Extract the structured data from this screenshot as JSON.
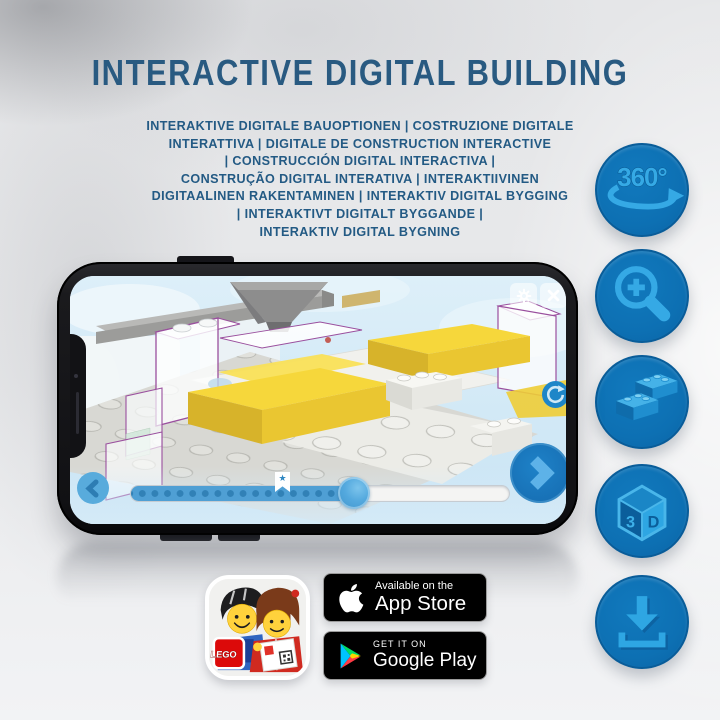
{
  "header": {
    "title": "INTERACTIVE DIGITAL BUILDING",
    "subtitle_lines": [
      "INTERAKTIVE DIGITALE BAUOPTIONEN | COSTRUZIONE DIGITALE",
      "INTERATTIVA | DIGITALE DE CONSTRUCTION INTERACTIVE",
      "| CONSTRUCCIÓN DIGITAL INTERACTIVA |",
      "CONSTRUÇÃO DIGITAL INTERATIVA | INTERAKTIIVINEN",
      "DIGITAALINEN RAKENTAMINEN | INTERAKTIV DIGITAL BYGGING",
      "| INTERAKTIVT DIGITALT BYGGANDE |",
      "INTERAKTIV DIGITAL BYGNING"
    ]
  },
  "features": [
    {
      "icon": "rotation-360-icon",
      "label": "360°"
    },
    {
      "icon": "zoom-in-icon"
    },
    {
      "icon": "lego-bricks-icon"
    },
    {
      "icon": "cube-3d-icon",
      "face_left": "3",
      "face_right": "D"
    },
    {
      "icon": "download-icon"
    }
  ],
  "phone": {
    "slider": {
      "progress_percent": 60,
      "bookmark_star": "★"
    }
  },
  "badges": {
    "lego_app": {
      "logo_text": "LEGO"
    },
    "app_store": {
      "tagline": "Available on the",
      "store_name": "App Store"
    },
    "google_play": {
      "tagline": "GET IT ON",
      "store_name": "Google Play"
    }
  },
  "colors": {
    "title_blue": "#295a81",
    "circle_blue": "#0e72b5",
    "icon_light_blue": "#2ea6e3",
    "screen_accent_blue": "#1e86c8",
    "brick_yellow": "#f6d73b"
  }
}
